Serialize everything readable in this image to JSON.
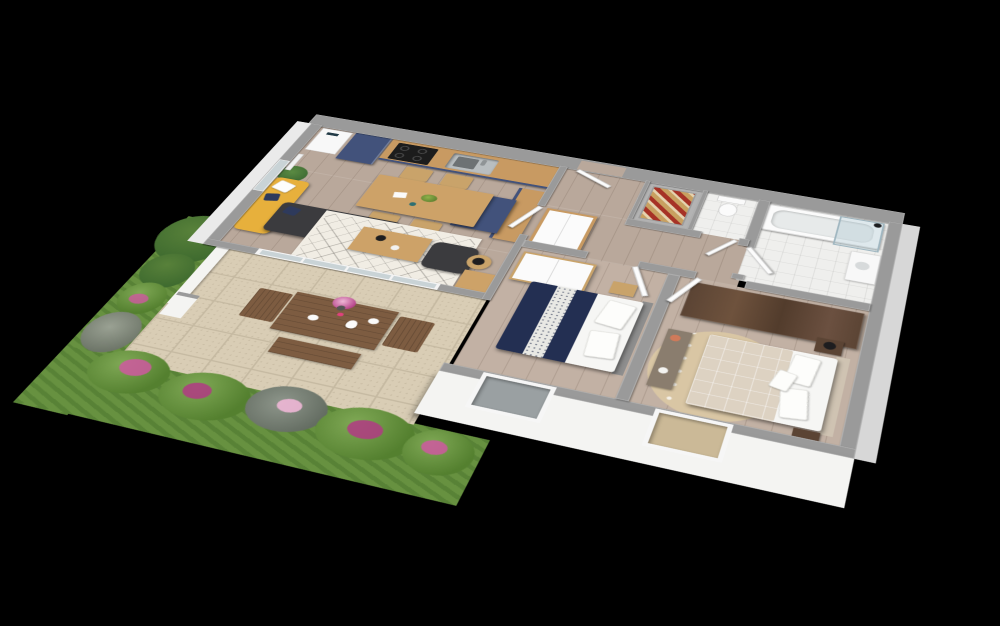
{
  "scene": {
    "type": "3d-floor-plan-render",
    "view": "isometric-birds-eye",
    "background": "#000000"
  },
  "palette": {
    "background": "#000000",
    "wall_top": "#9a9a9a",
    "wall_face": "#f4f4f2",
    "apron_gray": "#d7d7d7",
    "apron_light": "#eaeaea",
    "wood_floor": "#b9a89b",
    "bedroom_floor": "#c2b1a4",
    "kitchen_cabinet": "#42527b",
    "worktop_oak": "#c89a62",
    "table_oak": "#cda268",
    "chair_oak": "#c9a36a",
    "sofa_charcoal": "#3b3b3e",
    "sofa_yellow": "#e7b03c",
    "cushion_navy": "#2e3a5c",
    "rug_ivory": "#f1ede4",
    "terrace_tile": "#d9cdb5",
    "terrace_grout": "#c6baa2",
    "grass": "#679140",
    "shrub_green": "#54802f",
    "shrub_light": "#7fa855",
    "tree_green": "#3f6b2f",
    "flower_pink": "#cf58a0",
    "flower_magenta": "#b23a84",
    "flower_blush": "#eeb7d6",
    "outdoor_wood": "#7d5c41",
    "duvet_navy": "#232f52",
    "bed_white": "#f6f6f4",
    "headboard_gray": "#8e8e8e",
    "bed_beige": "#ddd2c2",
    "rug_round": "#d9c6a4",
    "wardrobe_walnut": "#5b4434",
    "bath_tile": "#efefed",
    "tub_white": "#fbfbfb",
    "glass_blue": "#c2d4da",
    "door_white": "#fcfcfc",
    "window_glass": "#c9d3d6",
    "laundry_tan": "#c8a060",
    "laundry_red": "#a63226",
    "lamp_black": "#1d1d1f",
    "cooktop_black": "#1c1c1c",
    "sink_steel": "#b9bec0",
    "plant_green": "#3e6b33"
  },
  "floorplan": {
    "rooms": [
      {
        "name": "living-room-kitchen",
        "furniture": [
          "water-heater",
          "fridge-cabinet",
          "kitchen-counter",
          "cooktop",
          "sink",
          "bar-counter",
          "kitchen-island",
          "dining-table",
          "dining-chairs",
          "fruit-bowl",
          "armchair-yellow",
          "sofa-charcoal",
          "cushions",
          "area-rug",
          "coffee-table",
          "floor-pouf",
          "side-table",
          "floor-lamp",
          "potted-plant",
          "radiator",
          "window",
          "sliding-glass-door"
        ]
      },
      {
        "name": "hallway",
        "furniture": [
          "entrance-door",
          "sideboard-cabinet",
          "interior-doors"
        ]
      },
      {
        "name": "laundry-closet",
        "furniture": [
          "drying-rack"
        ]
      },
      {
        "name": "wc",
        "furniture": [
          "toilet"
        ]
      },
      {
        "name": "bathroom",
        "furniture": [
          "bathtub",
          "shower-screen",
          "shower-head",
          "washbasin"
        ]
      },
      {
        "name": "bedroom-1",
        "furniture": [
          "double-bed-navy",
          "pillows",
          "wardrobe-white",
          "nightstand",
          "window"
        ]
      },
      {
        "name": "bedroom-2",
        "furniture": [
          "double-bed-beige",
          "pillows",
          "wardrobe-walnut",
          "round-rug",
          "console-bench",
          "nightstand-top",
          "nightstand-bottom",
          "table-lamp",
          "window"
        ]
      },
      {
        "name": "terrace",
        "furniture": [
          "outdoor-table",
          "outdoor-chairs",
          "outdoor-bench",
          "flower-vase",
          "pitcher",
          "plates",
          "privacy-wall",
          "pillar"
        ]
      },
      {
        "name": "garden",
        "furniture": [
          "lawn",
          "flower-bed",
          "shrubs",
          "trees"
        ]
      }
    ]
  }
}
